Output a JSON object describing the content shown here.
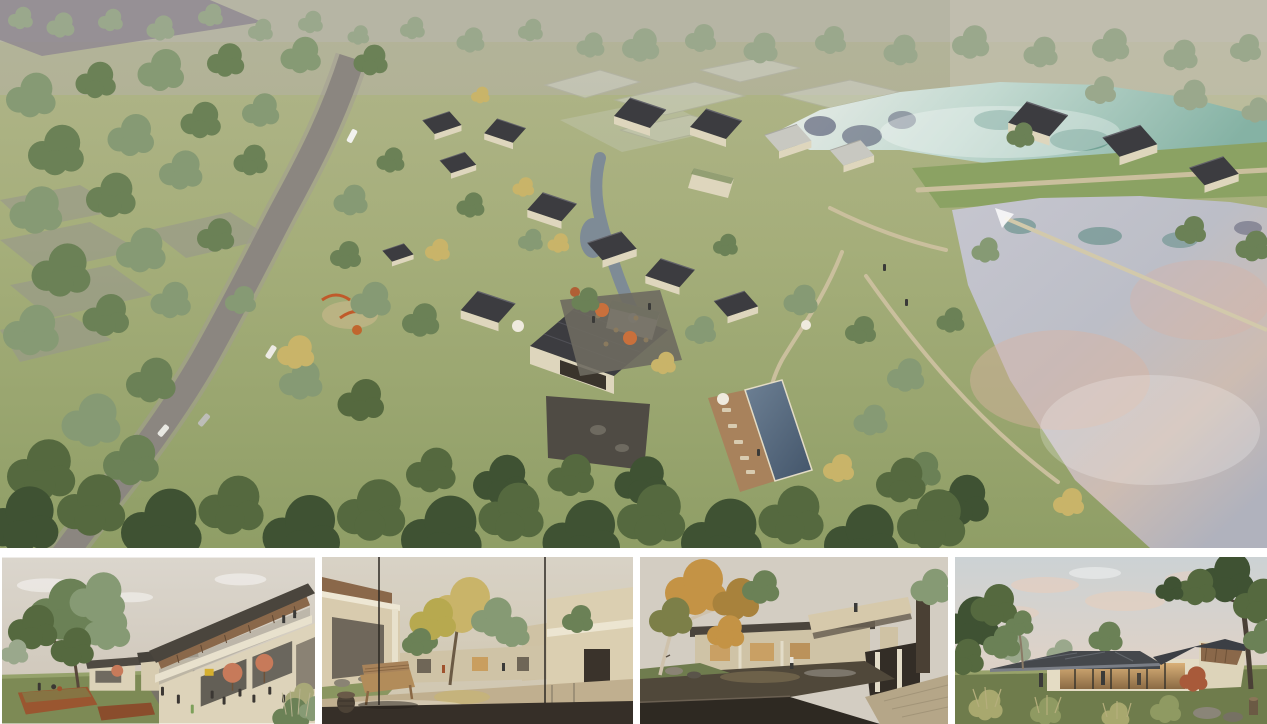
{
  "board": {
    "kind": "architectural rendering presentation board",
    "hero": {
      "id": "aerial-masterplan",
      "alt": "Aerial rendering of a lakeside village resort: clusters of cream guesthouses with dark gabled roofs along a winding stream, cafe terrace with orange umbrellas, playground, swimming pool terrace, a curving grey access road through dense woodland on the left, ghosted context buildings at the top, and two large reflective lakes divided by a grass causeway on the right"
    },
    "thumbnails": [
      {
        "id": "plaza-street-view",
        "alt": "Eye-level rendering of the village plaza: visitors dine under salmon umbrellas beside a two-storey building with a timber-soffit roof rising to the right, a large spreading tree shades a lawn with corten steel planters"
      },
      {
        "id": "courtyard-pond-view",
        "alt": "Rendering of a quiet courtyard: a wicker bench and carved stool sit on a dark deck before a reflecting pond, with a golden tree and cream buildings beyond"
      },
      {
        "id": "waterfall-court-view",
        "alt": "Rendering of a stone courtyard pond with a low waterfall edge, an autumn tree with pale trunk on the left and a cantilevered cream balcony volume on the right"
      },
      {
        "id": "pavilion-lawn-view",
        "alt": "Rendering at dusk of a single-storey glass pavilion with a dark hipped roof and warm glowing interior, framed by mature trees, ornamental grasses, rocks and a stump on the lawn"
      }
    ]
  },
  "palette": {
    "gap": "#ffffff",
    "grassLight": "#aab180",
    "grassDeep": "#8f9e66",
    "hazeTop": "#b4b1a7",
    "fieldGray": "#97968e",
    "ghostGray": "#d4d5cf",
    "road": "#8b8680",
    "roadEdge": "#a59f95",
    "roofDark": "#3c3c40",
    "roofLight": "#c8c8c1",
    "wall": "#ded6bd",
    "stoneDark": "#4f4b44",
    "stream": "#7e8b96",
    "lakeWhite": "#eceeea",
    "lakeTeal": "#85b2a4",
    "reflNavy": "#3e4160",
    "reflTeal": "#2f7263",
    "lakeSilver": "#c2c2cb",
    "lakePink": "#d9b3a2",
    "pathTan": "#cabf9d",
    "pool": "#55687c",
    "deckWood": "#a8825c",
    "umbrellaOrange": "#c9703c",
    "umbrellaSalmon": "#c77a5a",
    "umbrellaWhite": "#efeade",
    "playOrange": "#c05a2a",
    "rust": "#9a5630",
    "treeSage": "#869a74",
    "treeMid": "#6b8156",
    "treeDark": "#55693f",
    "treeDeep": "#3f5233",
    "treeYellow": "#c9b469",
    "treeMuted": "#9aa88c",
    "treeAutumn": "#c49345",
    "mapleRed": "#a85a3a",
    "skyPale": "#d9d3c9",
    "wood": "#8a684a",
    "lawn": "#7d8a55",
    "pave": "#787368",
    "waterBeige": "#c0af8f",
    "deckDark": "#362f28",
    "bench": "#b28c5a",
    "pondDark": "#50483a",
    "paveWarm": "#b5a688",
    "roofBlue": "#45484c",
    "glow": "#c89a58",
    "cloudPink": "#e8cdbc",
    "ppl": "#3a3a38"
  }
}
